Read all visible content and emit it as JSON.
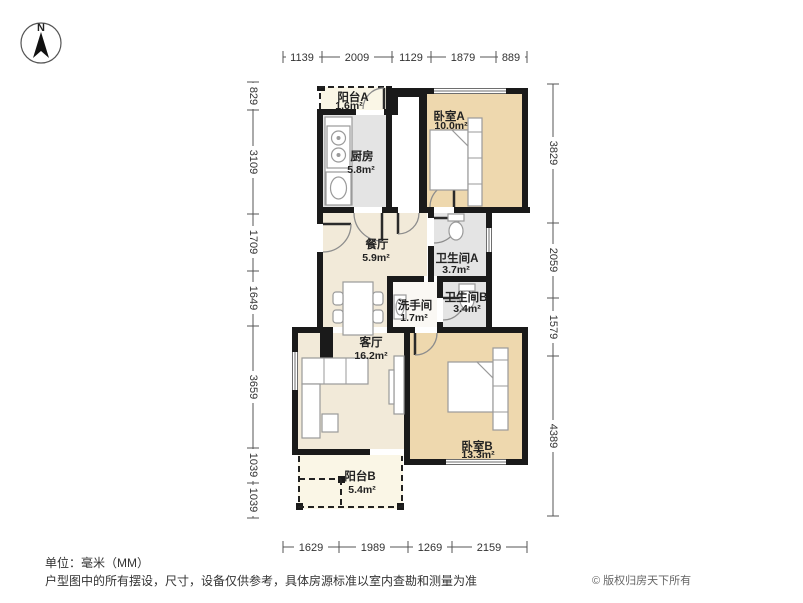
{
  "compass": {
    "label": "N"
  },
  "rooms": {
    "balcony_a": {
      "name": "阳台A",
      "area": "1.6m²"
    },
    "kitchen": {
      "name": "厨房",
      "area": "5.8m²"
    },
    "bedroom_a": {
      "name": "卧室A",
      "area": "10.0m²"
    },
    "dining": {
      "name": "餐厅",
      "area": "5.9m²"
    },
    "bathroom_a": {
      "name": "卫生间A",
      "area": "3.7m²"
    },
    "washroom": {
      "name": "洗手间",
      "area": "1.7m²"
    },
    "bathroom_b": {
      "name": "卫生间B",
      "area": "3.4m²"
    },
    "living": {
      "name": "客厅",
      "area": "16.2m²"
    },
    "bedroom_b": {
      "name": "卧室B",
      "area": "13.3m²"
    },
    "balcony_b": {
      "name": "阳台B",
      "area": "5.4m²"
    }
  },
  "dimensions": {
    "top": [
      1139,
      2009,
      1129,
      1879,
      889
    ],
    "bottom": [
      1629,
      1989,
      1269,
      2159
    ],
    "left": [
      829,
      3109,
      1709,
      1649,
      3659,
      1039,
      1039
    ],
    "right": [
      3829,
      2059,
      1579,
      4389
    ]
  },
  "footer": {
    "unit_note": "单位：毫米（MM）",
    "disclaimer": "户型图中的所有摆设，尺寸，设备仅供参考，具体房源标准以室内查勘和测量为准",
    "copyright": "© 版权归房天下所有"
  },
  "colors": {
    "wall": "#1a1a1a",
    "bedroom_floor": "#eed8ae",
    "living_floor": "#f2ead9",
    "wet_floor": "#e4e4e4",
    "balcony_floor": "#faf6e6"
  }
}
